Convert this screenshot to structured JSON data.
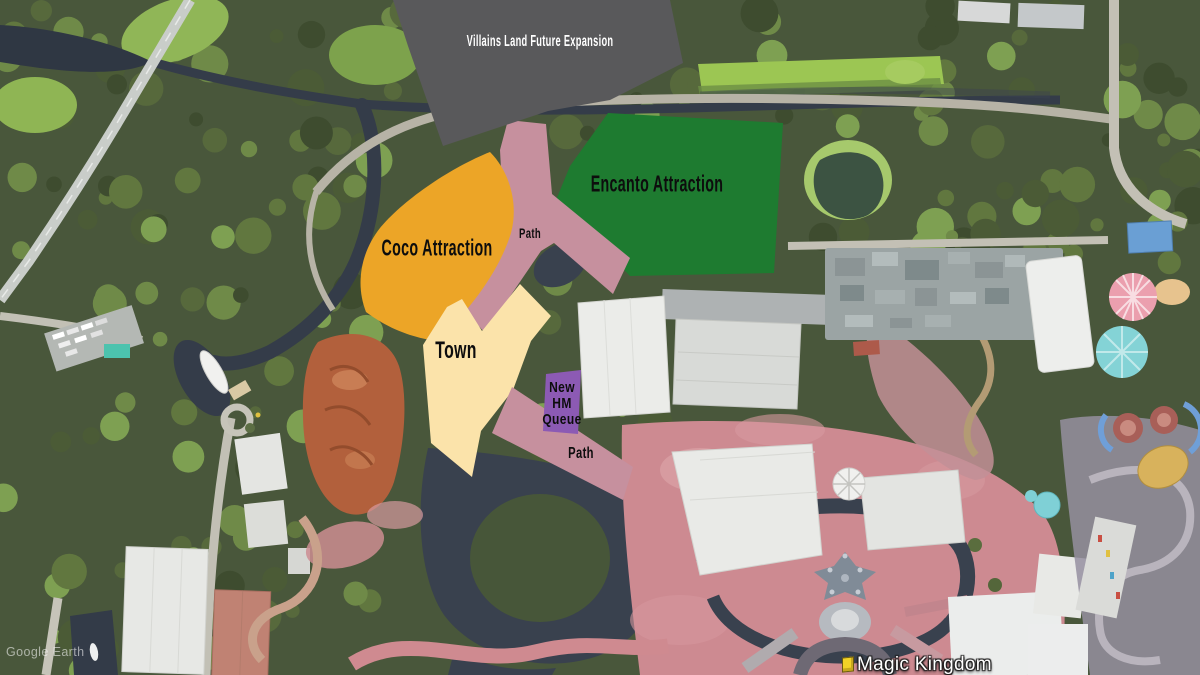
{
  "map": {
    "watermark": "Google Earth",
    "place_label": "Magic Kingdom"
  },
  "zones": {
    "villains": {
      "label": "Villains Land Future Expansion",
      "fill": "#59595b",
      "text_color": "#ffffff"
    },
    "encanto": {
      "label": "Encanto Attraction",
      "fill": "#1e7b30",
      "text_color": "#0d0d0d"
    },
    "coco": {
      "label": "Coco Attraction",
      "fill": "#eca527",
      "text_color": "#0d0d0d"
    },
    "town": {
      "label": "Town",
      "fill": "#fbe3aa",
      "text_color": "#0d0d0d"
    },
    "hm_queue": {
      "lines": [
        "New",
        "HM",
        "Queue"
      ],
      "fill": "#8c5ab4",
      "text_color": "#0d0d0d"
    },
    "path_upper": {
      "label": "Path",
      "fill": "#c6909e",
      "text_color": "#0d0d0d"
    },
    "path_lower": {
      "label": "Path",
      "fill": "#c6909e",
      "text_color": "#0d0d0d"
    }
  }
}
